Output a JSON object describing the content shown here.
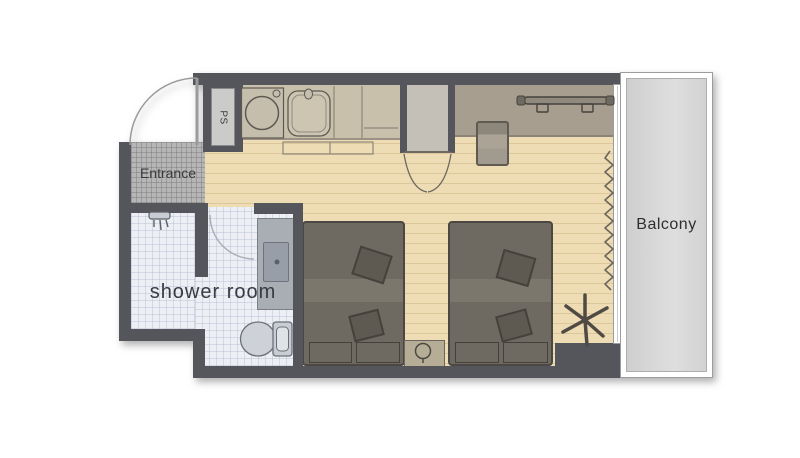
{
  "plan_title": "studio-room-floor-plan",
  "labels": {
    "entrance": "Entrance",
    "shower_room": "shower room",
    "balcony": "Balcony",
    "pipe_shaft": "PS"
  },
  "colors": {
    "wall": "#54565b",
    "floor": "#eedcb4",
    "floor_stripe": "#dcc79a",
    "counter": "#c8c0ab",
    "desk": "#a79e8f",
    "closet": "#c4c0b8",
    "entrance_tile": "#b6b6b6",
    "shower_tile": "#edeff5",
    "bed": "#6e6a61",
    "bed_band": "#7c776d",
    "pillow": "#5e5a52",
    "nightstand": "#b6ad96",
    "chair": "#a19a8e",
    "fixture": "#a9aeb4",
    "balcony_fill": "#d8d8d8",
    "text": "#3c3c3c"
  },
  "fixtures": [
    "entrance-door",
    "pipe-shaft",
    "washing-machine",
    "kitchen-sink",
    "kitchen-counter",
    "bifold-closet",
    "desk",
    "desk-chair",
    "luggage-rack",
    "curtain",
    "balcony-window",
    "bed-left",
    "bed-right",
    "nightstand",
    "table-lamp",
    "plant",
    "shower-head",
    "shower-door",
    "vanity-sink",
    "toilet"
  ]
}
